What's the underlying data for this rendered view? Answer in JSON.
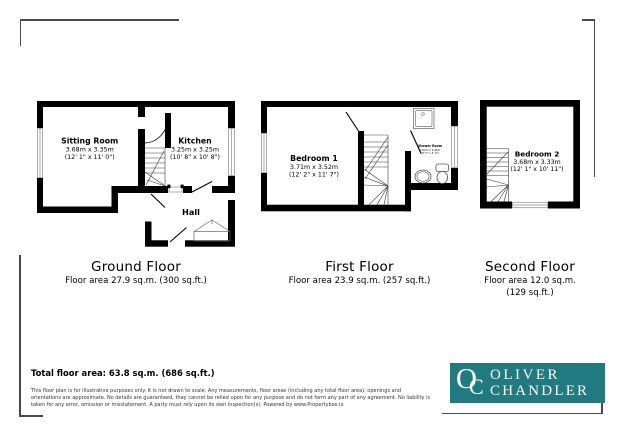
{
  "ground": {
    "title": "Ground Floor",
    "area": "Floor area 27.9 sq.m. (300 sq.ft.)",
    "sitting_room": {
      "name": "Sitting Room",
      "metric": "3.68m x 3.35m",
      "imperial": "(12' 1\" x 11' 0\")"
    },
    "kitchen": {
      "name": "Kitchen",
      "metric": "3.25m x 3.25m",
      "imperial": "(10' 8\" x 10' 8\")"
    },
    "hall": {
      "name": "Hall"
    }
  },
  "first": {
    "title": "First Floor",
    "area": "Floor area 23.9 sq.m. (257 sq.ft.)",
    "bedroom1": {
      "name": "Bedroom 1",
      "metric": "3.71m x 3.52m",
      "imperial": "(12' 2\" x 11' 7\")"
    },
    "shower": {
      "name": "Shower Room",
      "metric": "2.62m x 1.45m",
      "imperial": "(8' 7\" x 4' 9\")"
    }
  },
  "second": {
    "title": "Second Floor",
    "area_metric": "Floor area 12.0 sq.m.",
    "area_imperial": "(129 sq.ft.)",
    "bedroom2": {
      "name": "Bedroom 2",
      "metric": "3.68m x 3.33m",
      "imperial": "(12' 1\" x 10' 11\")"
    }
  },
  "summary": {
    "total_area": "Total floor area: 63.8 sq.m. (686 sq.ft.)"
  },
  "disclaimer": {
    "line1": "This floor plan is for illustrative purposes only. It is not drawn to scale. Any measurements, floor areas (including any total floor area), openings and",
    "line2": "orientations are approximate. No details are guaranteed, they cannot be relied upon for any purpose and do not form any part of any agreement. No liability is",
    "line3": "taken for any error, omission or misstatement. A party must rely upon its own inspection(s). Powered by www.Propertybox.io"
  },
  "logo": {
    "monogram_o": "O",
    "monogram_c": "C",
    "line1": "OLIVER",
    "line2": "CHANDLER",
    "bg_color": "#207a80",
    "text_color": "#ffffff"
  }
}
